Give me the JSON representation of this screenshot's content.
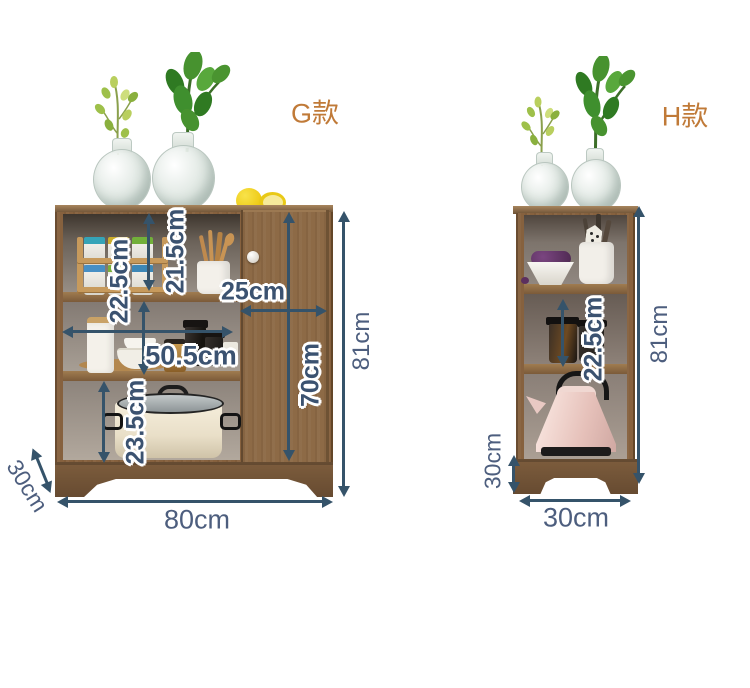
{
  "colors": {
    "accent_orange": "#c07a38",
    "dimension_navy": "#3b5270",
    "arrow": "#35536a",
    "wood": "#86613e"
  },
  "g": {
    "model_label": "G款",
    "dims": {
      "top_opening": "21.5cm",
      "middle_opening": "22.5cm",
      "door_width": "25cm",
      "open_width": "50.5cm",
      "door_height": "70cm",
      "height": "81cm",
      "bottom_opening": "23.5cm",
      "depth": "30cm",
      "width": "80cm"
    }
  },
  "h": {
    "model_label": "H款",
    "dims": {
      "opening": "22.5cm",
      "height": "81cm",
      "depth": "30cm",
      "width": "30cm"
    }
  }
}
